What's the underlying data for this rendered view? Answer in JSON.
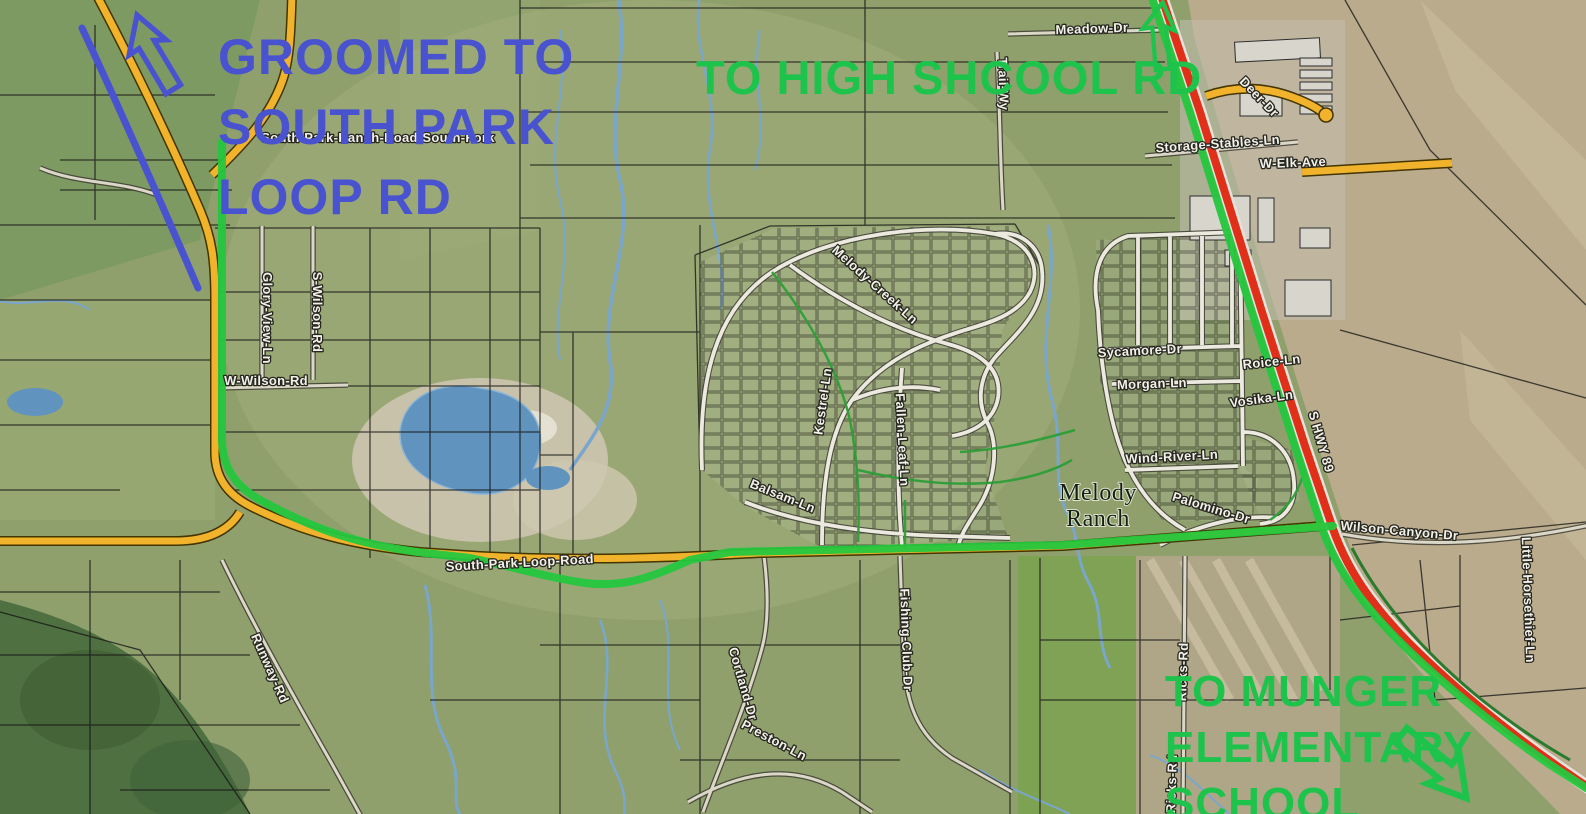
{
  "map": {
    "annotations": {
      "groomed": {
        "lines": [
          "GROOMED TO",
          "SOUTH PARK",
          "LOOP RD"
        ],
        "color": "#4953d0",
        "arrow_icon": "blue-outline-arrow-up"
      },
      "high_school": {
        "lines": [
          "TO HIGH SHCOOL RD"
        ],
        "color": "#1ec34b",
        "arrow_icon": "green-outline-arrow-up"
      },
      "munger": {
        "lines": [
          "TO MUNGER",
          "ELEMENTARY",
          "SCHOOL"
        ],
        "color": "#1ec34b",
        "arrow_icon": "green-outline-arrow-down-right"
      }
    },
    "routes": {
      "groomed_line_color": "#4953d0",
      "trail_route_color": "#25c73e",
      "highway_color": "#e0301a",
      "main_road_color": "#f2b32c"
    },
    "place_labels": [
      {
        "text": "Melody",
        "x": 1098,
        "y": 500,
        "rot": 0
      },
      {
        "text": "Ranch",
        "x": 1098,
        "y": 526,
        "rot": 0
      }
    ],
    "road_labels": [
      {
        "text": "South-Park-Ranch-Road-South-Fork",
        "x": 378,
        "y": 142,
        "rot": 0
      },
      {
        "text": "Glory-View-Ln",
        "x": 263,
        "y": 318,
        "rot": 90
      },
      {
        "text": "S-Wilson-Rd",
        "x": 313,
        "y": 312,
        "rot": 90
      },
      {
        "text": "W-Wilson-Rd",
        "x": 266,
        "y": 385,
        "rot": 0
      },
      {
        "text": "Meadow-Dr",
        "x": 1092,
        "y": 33,
        "rot": -2
      },
      {
        "text": "Trail-Wy",
        "x": 999,
        "y": 84,
        "rot": 88
      },
      {
        "text": "Deer-Dr",
        "x": 1256,
        "y": 100,
        "rot": 46
      },
      {
        "text": "Storage-Stables-Ln",
        "x": 1218,
        "y": 148,
        "rot": -4
      },
      {
        "text": "W-Elk-Ave",
        "x": 1293,
        "y": 167,
        "rot": -2
      },
      {
        "text": "Melody-Creek-Ln",
        "x": 872,
        "y": 288,
        "rot": 42,
        "size": 14
      },
      {
        "text": "Kestrel-Ln",
        "x": 827,
        "y": 402,
        "rot": -82
      },
      {
        "text": "Fallen-Leaf-Ln",
        "x": 898,
        "y": 440,
        "rot": 87
      },
      {
        "text": "Balsam-Ln",
        "x": 781,
        "y": 500,
        "rot": 22
      },
      {
        "text": "Sycamore-Dr",
        "x": 1140,
        "y": 355,
        "rot": -3
      },
      {
        "text": "Morgan-Ln",
        "x": 1152,
        "y": 388,
        "rot": -2
      },
      {
        "text": "Roice-Ln",
        "x": 1272,
        "y": 366,
        "rot": -6
      },
      {
        "text": "Vosika-Ln",
        "x": 1262,
        "y": 403,
        "rot": -8
      },
      {
        "text": "Wind-River-Ln",
        "x": 1172,
        "y": 461,
        "rot": -3
      },
      {
        "text": "Palomino-Dr",
        "x": 1210,
        "y": 512,
        "rot": 17
      },
      {
        "text": "S HWY 89",
        "x": 1317,
        "y": 443,
        "rot": 74,
        "size": 16
      },
      {
        "text": "Wilson-Canyon-Dr",
        "x": 1399,
        "y": 535,
        "rot": 5
      },
      {
        "text": "Little-Horsethief-Ln",
        "x": 1524,
        "y": 600,
        "rot": 88,
        "size": 12
      },
      {
        "text": "South-Park-Loop-Road",
        "x": 520,
        "y": 567,
        "rot": -3,
        "size": 15
      },
      {
        "text": "Runway-Rd",
        "x": 266,
        "y": 670,
        "rot": 66
      },
      {
        "text": "Cortland-Dr",
        "x": 739,
        "y": 685,
        "rot": 74
      },
      {
        "text": "Preston-Ln",
        "x": 772,
        "y": 744,
        "rot": 28
      },
      {
        "text": "Fishing-Club-Dr",
        "x": 902,
        "y": 640,
        "rot": 88
      },
      {
        "text": "Ricks-Rd",
        "x": 1187,
        "y": 672,
        "rot": -88,
        "size": 12
      },
      {
        "text": "Ricks-Rd",
        "x": 1176,
        "y": 784,
        "rot": -88,
        "size": 12
      }
    ]
  }
}
